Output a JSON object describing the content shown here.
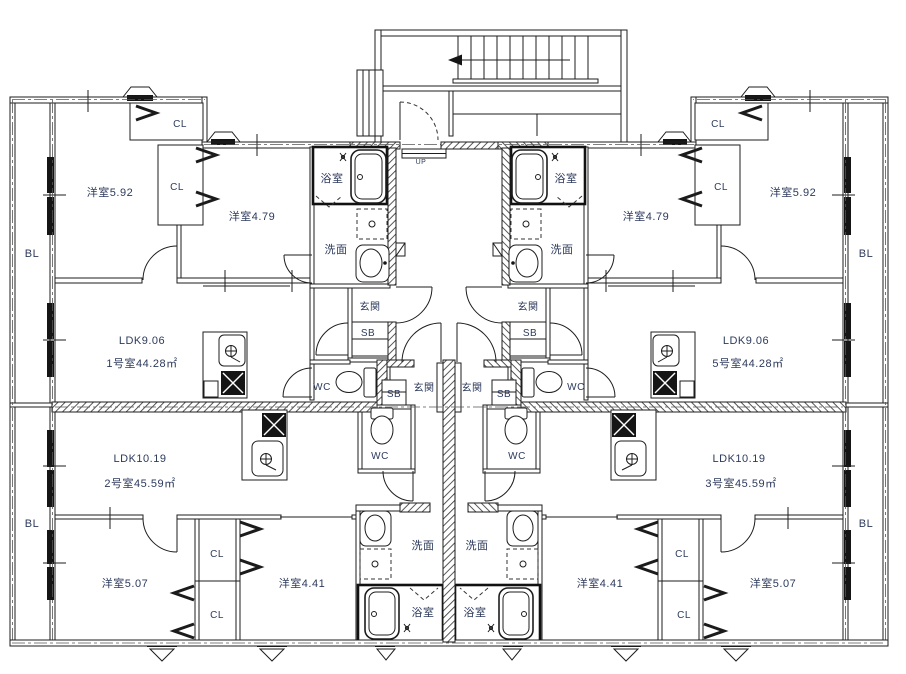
{
  "drawing": {
    "kind": "apartment-floor-plan",
    "language": "ja",
    "stair_direction_label": "UP"
  },
  "palette": {
    "line": "#1d1d1d",
    "text": "#2c3a5c",
    "background": "#ffffff"
  },
  "units": [
    {
      "id": "1号室",
      "area_label": "1号室44.28㎡",
      "ldk_label": "LDK9.06",
      "rooms": [
        "洋室5.92",
        "洋室4.79",
        "CL",
        "CL",
        "浴室",
        "洗面",
        "玄関",
        "SB",
        "WC"
      ],
      "balcony": "BL"
    },
    {
      "id": "2号室",
      "area_label": "2号室45.59㎡",
      "ldk_label": "LDK10.19",
      "rooms": [
        "洋室5.07",
        "洋室4.41",
        "CL",
        "CL",
        "浴室",
        "洗面",
        "玄関",
        "SB",
        "WC"
      ],
      "balcony": "BL"
    },
    {
      "id": "3号室",
      "area_label": "3号室45.59㎡",
      "ldk_label": "LDK10.19",
      "rooms": [
        "洋室4.41",
        "洋室5.07",
        "CL",
        "CL",
        "浴室",
        "洗面",
        "玄関",
        "SB",
        "WC"
      ],
      "balcony": "BL"
    },
    {
      "id": "5号室",
      "area_label": "5号室44.28㎡",
      "ldk_label": "LDK9.06",
      "rooms": [
        "洋室4.79",
        "洋室5.92",
        "CL",
        "CL",
        "浴室",
        "洗面",
        "玄関",
        "SB",
        "WC"
      ],
      "balcony": "BL"
    }
  ],
  "labels": [
    {
      "name": "label-bl-top-left",
      "text": "BL",
      "x": 32,
      "y": 257,
      "fs": 11
    },
    {
      "name": "label-room-592-left",
      "text": "洋室5.92",
      "x": 110,
      "y": 196,
      "fs": 11
    },
    {
      "name": "label-cl-top-left",
      "text": "CL",
      "x": 180,
      "y": 127,
      "fs": 10
    },
    {
      "name": "label-cl-mid-left",
      "text": "CL",
      "x": 177,
      "y": 190,
      "fs": 10
    },
    {
      "name": "label-room-479-left",
      "text": "洋室4.79",
      "x": 252,
      "y": 220,
      "fs": 11
    },
    {
      "name": "label-bath-left",
      "text": "浴室",
      "x": 332,
      "y": 182,
      "fs": 11
    },
    {
      "name": "label-wash-left",
      "text": "洗面",
      "x": 336,
      "y": 253,
      "fs": 11
    },
    {
      "name": "label-entry-1",
      "text": "玄関",
      "x": 370,
      "y": 310,
      "fs": 10
    },
    {
      "name": "label-sb-1",
      "text": "SB",
      "x": 368,
      "y": 336,
      "fs": 10
    },
    {
      "name": "label-wc-1",
      "text": "WC",
      "x": 322,
      "y": 390,
      "fs": 10
    },
    {
      "name": "label-ldk-1",
      "text": "LDK9.06",
      "x": 142,
      "y": 344,
      "fs": 11
    },
    {
      "name": "label-unit-1",
      "text": "1号室44.28㎡",
      "x": 142,
      "y": 367,
      "fs": 11
    },
    {
      "name": "label-up",
      "text": "UP",
      "x": 421,
      "y": 164,
      "fs": 7,
      "muted": true
    },
    {
      "name": "label-entry-2",
      "text": "玄関",
      "x": 424,
      "y": 391,
      "fs": 10
    },
    {
      "name": "label-sb-2",
      "text": "SB",
      "x": 394,
      "y": 397,
      "fs": 10
    },
    {
      "name": "label-wc-2",
      "text": "WC",
      "x": 380,
      "y": 459,
      "fs": 10
    },
    {
      "name": "label-wash-2",
      "text": "洗面",
      "x": 423,
      "y": 549,
      "fs": 11
    },
    {
      "name": "label-bath-2",
      "text": "浴室",
      "x": 423,
      "y": 616,
      "fs": 11
    },
    {
      "name": "label-ldk-2",
      "text": "LDK10.19",
      "x": 140,
      "y": 462,
      "fs": 11
    },
    {
      "name": "label-unit-2",
      "text": "2号室45.59㎡",
      "x": 140,
      "y": 487,
      "fs": 11
    },
    {
      "name": "label-bl-bottom-left",
      "text": "BL",
      "x": 32,
      "y": 527,
      "fs": 11
    },
    {
      "name": "label-room-507-left",
      "text": "洋室5.07",
      "x": 125,
      "y": 587,
      "fs": 11
    },
    {
      "name": "label-cl-up-left2",
      "text": "CL",
      "x": 217,
      "y": 557,
      "fs": 10
    },
    {
      "name": "label-cl-low-left2",
      "text": "CL",
      "x": 217,
      "y": 618,
      "fs": 10
    },
    {
      "name": "label-room-441-left",
      "text": "洋室4.41",
      "x": 302,
      "y": 587,
      "fs": 11
    },
    {
      "name": "label-bath-right",
      "text": "浴室",
      "x": 566,
      "y": 182,
      "fs": 11
    },
    {
      "name": "label-room-479-right",
      "text": "洋室4.79",
      "x": 646,
      "y": 220,
      "fs": 11
    },
    {
      "name": "label-cl-top-right",
      "text": "CL",
      "x": 718,
      "y": 127,
      "fs": 10
    },
    {
      "name": "label-cl-mid-right",
      "text": "CL",
      "x": 721,
      "y": 190,
      "fs": 10
    },
    {
      "name": "label-room-592-right",
      "text": "洋室5.92",
      "x": 793,
      "y": 196,
      "fs": 11
    },
    {
      "name": "label-bl-top-right",
      "text": "BL",
      "x": 866,
      "y": 257,
      "fs": 11
    },
    {
      "name": "label-wash-right",
      "text": "洗面",
      "x": 562,
      "y": 253,
      "fs": 11
    },
    {
      "name": "label-entry-5",
      "text": "玄関",
      "x": 528,
      "y": 310,
      "fs": 10
    },
    {
      "name": "label-sb-5",
      "text": "SB",
      "x": 530,
      "y": 336,
      "fs": 10
    },
    {
      "name": "label-wc-5",
      "text": "WC",
      "x": 576,
      "y": 390,
      "fs": 10
    },
    {
      "name": "label-ldk-5",
      "text": "LDK9.06",
      "x": 746,
      "y": 344,
      "fs": 11
    },
    {
      "name": "label-unit-5",
      "text": "5号室44.28㎡",
      "x": 748,
      "y": 367,
      "fs": 11
    },
    {
      "name": "label-entry-3",
      "text": "玄関",
      "x": 472,
      "y": 391,
      "fs": 10
    },
    {
      "name": "label-sb-3",
      "text": "SB",
      "x": 504,
      "y": 397,
      "fs": 10
    },
    {
      "name": "label-wc-3",
      "text": "WC",
      "x": 517,
      "y": 459,
      "fs": 10
    },
    {
      "name": "label-wash-3",
      "text": "洗面",
      "x": 477,
      "y": 549,
      "fs": 11
    },
    {
      "name": "label-bath-3",
      "text": "浴室",
      "x": 475,
      "y": 616,
      "fs": 11
    },
    {
      "name": "label-ldk-3",
      "text": "LDK10.19",
      "x": 739,
      "y": 462,
      "fs": 11
    },
    {
      "name": "label-unit-3",
      "text": "3号室45.59㎡",
      "x": 741,
      "y": 487,
      "fs": 11
    },
    {
      "name": "label-room-441-right",
      "text": "洋室4.41",
      "x": 600,
      "y": 587,
      "fs": 11
    },
    {
      "name": "label-cl-up-right2",
      "text": "CL",
      "x": 682,
      "y": 557,
      "fs": 10
    },
    {
      "name": "label-cl-low-right2",
      "text": "CL",
      "x": 684,
      "y": 618,
      "fs": 10
    },
    {
      "name": "label-room-507-right",
      "text": "洋室5.07",
      "x": 773,
      "y": 587,
      "fs": 11
    },
    {
      "name": "label-bl-bottom-right",
      "text": "BL",
      "x": 866,
      "y": 527,
      "fs": 11
    }
  ]
}
